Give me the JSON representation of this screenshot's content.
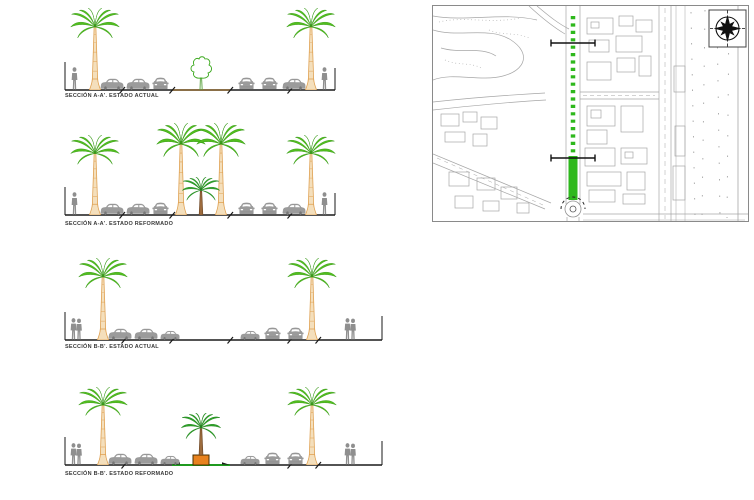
{
  "sheet": {
    "background": "#FFFFFF",
    "type": "urban street cross-sections with location plan"
  },
  "sections": [
    {
      "id": "a-actual",
      "label": "SECCIÓN A-A'. ESTADO ACTUAL"
    },
    {
      "id": "a-reformado",
      "label": "SECCIÓN A-A'. ESTADO REFORMADO"
    },
    {
      "id": "b-actual",
      "label": "SECCIÓN B-B'. ESTADO ACTUAL"
    },
    {
      "id": "b-reformado",
      "label": "SECCIÓN B-B'. ESTADO REFORMADO"
    }
  ],
  "map": {
    "name": "location-plan",
    "compass_icon": "compass-rose-icon",
    "highlighted_street_color": "#2EB81C",
    "cut_line_count": 2
  },
  "colors": {
    "palm_frond": "#52BE1E",
    "palm_frond_outline": "#2F9310",
    "palm_trunk": "#F4DFBC",
    "palm_trunk_outline": "#DFA050",
    "small_palm_frond": "#2EA32A",
    "small_palm_trunk": "#9C6B3D",
    "vehicle_gray": "#9B9B9B",
    "person_gray": "#8F8F8F",
    "ground_black": "#1A1A1A",
    "median_brown": "#8A6B3F",
    "median_green": "#1F9A1F",
    "planter_orange": "#E8821E",
    "map_linework": "#A6A6A6"
  }
}
